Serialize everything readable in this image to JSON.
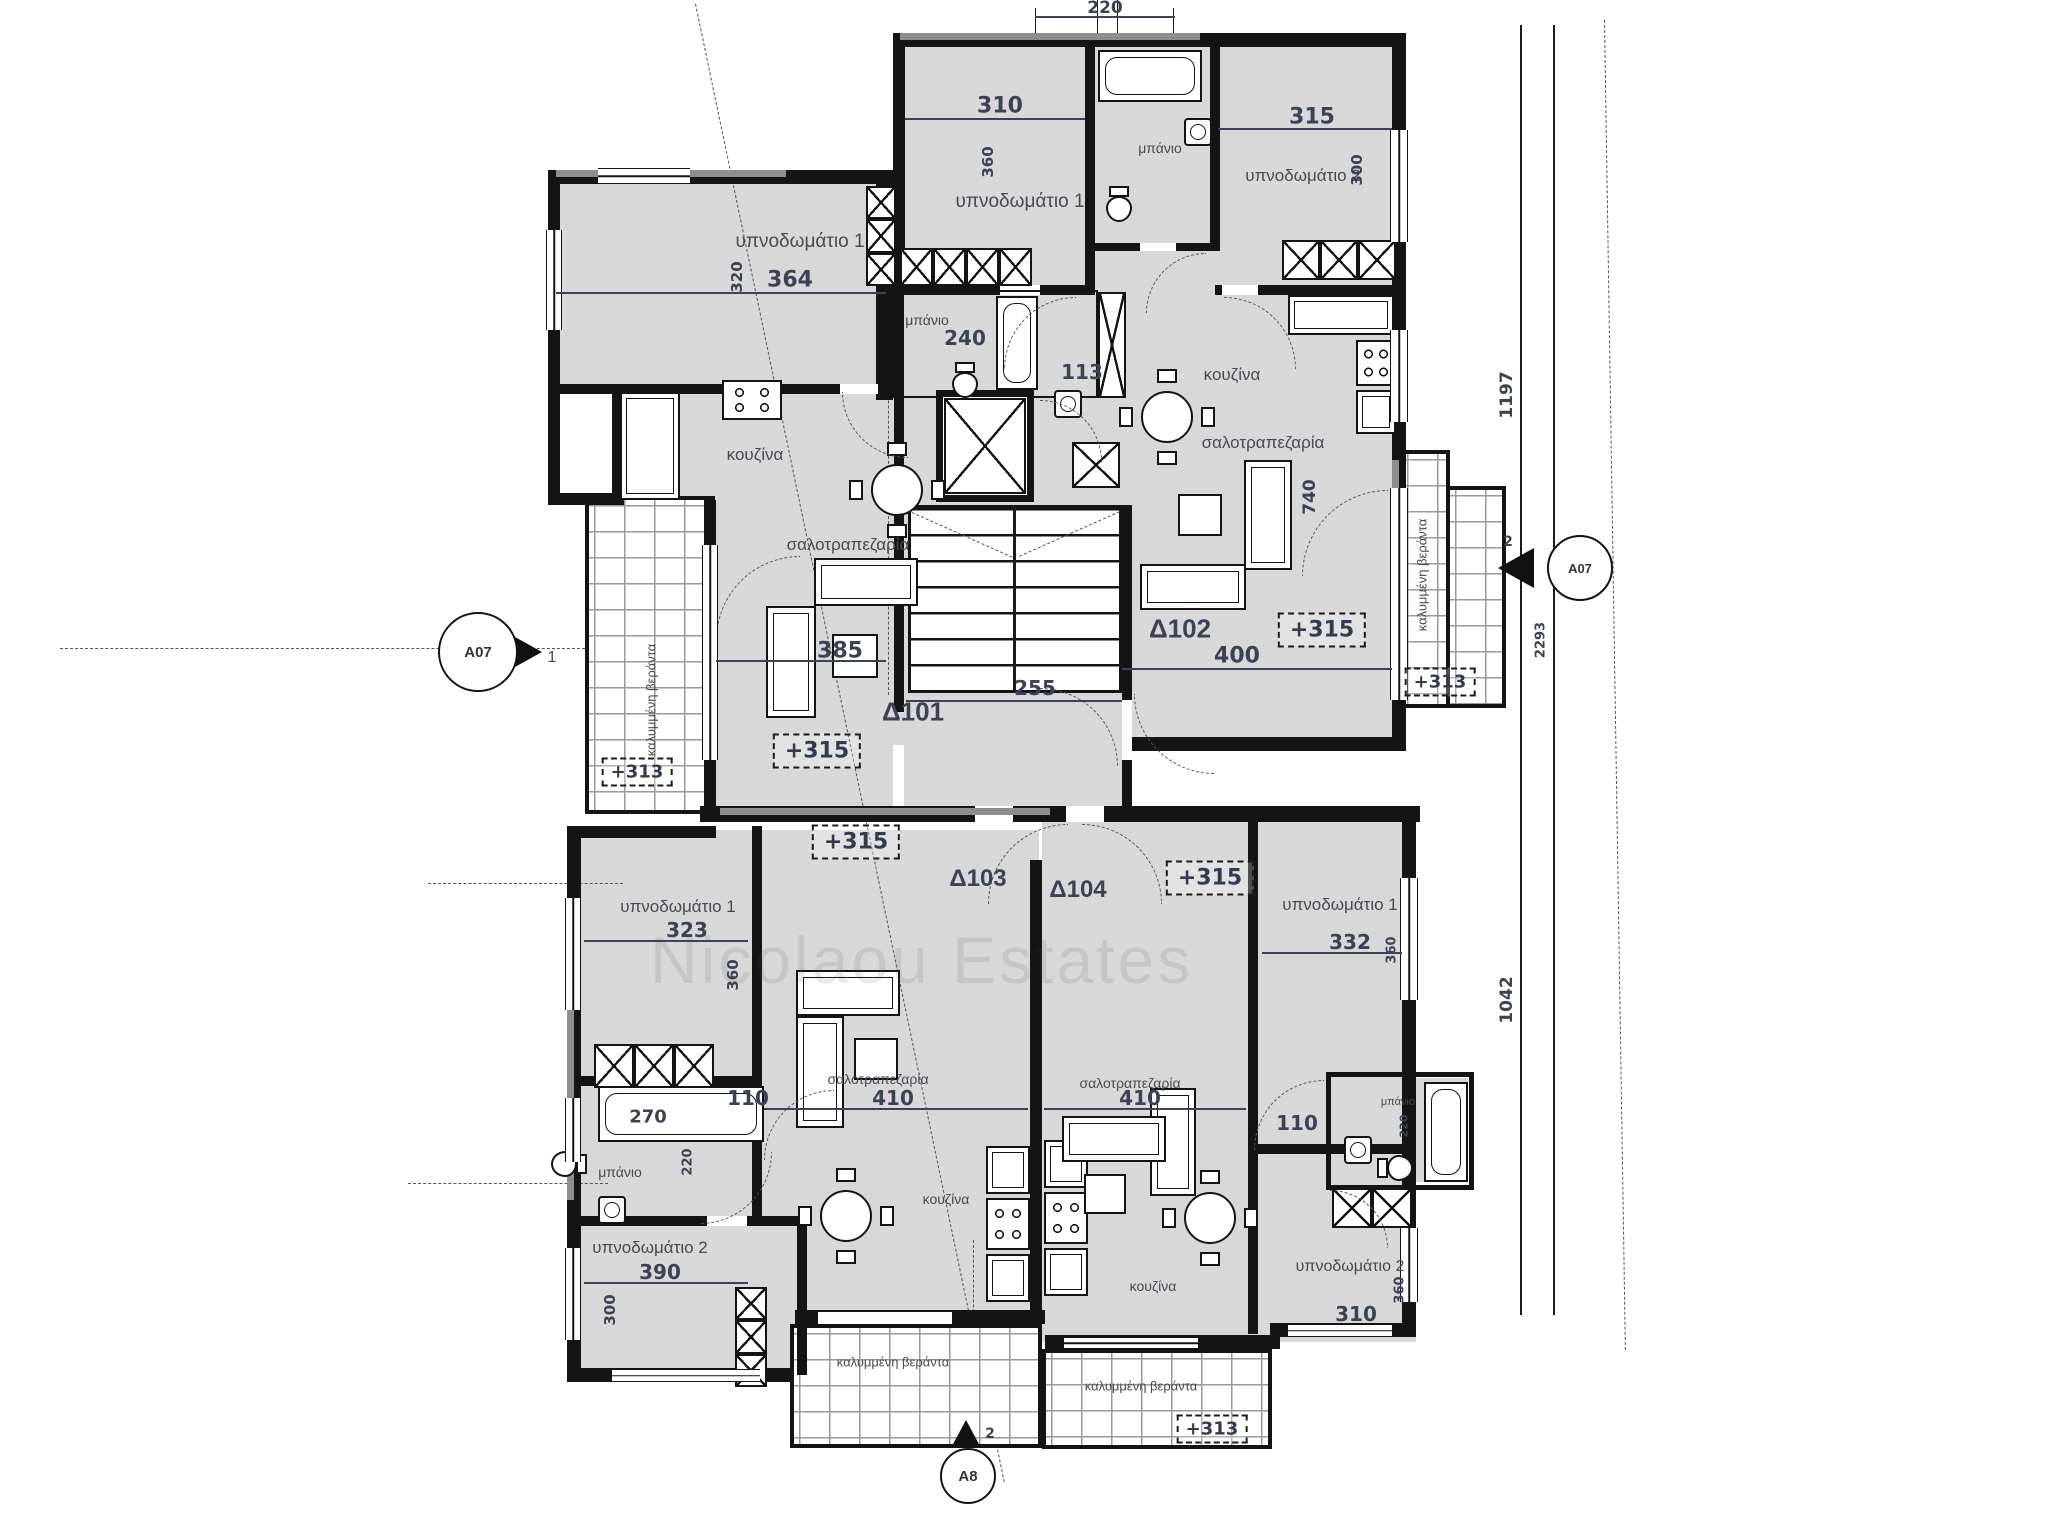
{
  "watermark": "Nicolaou Estates",
  "top_dimension": "220",
  "site_dimensions": {
    "right_upper": "1197",
    "right_total": "2293",
    "right_lower": "1042",
    "right_tick": "2",
    "bottom_tick": "2"
  },
  "section_markers": {
    "left": {
      "label": "A07",
      "number": "1"
    },
    "right": {
      "label": "A07"
    },
    "bottom": {
      "label": "A8"
    }
  },
  "hall": {
    "stair_width": "255"
  },
  "verandas": {
    "left": {
      "name": "καλυμμένη βεράντα",
      "level": "+313"
    },
    "right": {
      "name": "καλυμμένη βεράντα",
      "level": "+313"
    },
    "bottom_left": {
      "name": "καλυμμένη βεράντα"
    },
    "bottom_right": {
      "name": "καλυμμένη βεράντα",
      "level": "+313"
    }
  },
  "apartments": {
    "d101": {
      "id": "Δ101",
      "level": "+315",
      "bedroom1": {
        "name": "υπνοδωμάτιο 1",
        "width": "364",
        "depth": "320"
      },
      "bath": {
        "name": "μπάνιο",
        "width": "240",
        "door": "113"
      },
      "kitchen": {
        "name": "κουζίνα"
      },
      "living": {
        "name": "σαλοτραπεζαρία",
        "width": "385"
      }
    },
    "d102": {
      "id": "Δ102",
      "level": "+315",
      "bedroom1": {
        "name": "υπνοδωμάτιο 1",
        "width": "310",
        "depth": "360"
      },
      "bath": {
        "name": "μπάνιο"
      },
      "bedroom2": {
        "name": "υπνοδωμάτιο 2",
        "width": "315",
        "depth": "300"
      },
      "kitchen": {
        "name": "κουζίνα"
      },
      "living": {
        "name": "σαλοτραπεζαρία",
        "width": "400",
        "depth": "740"
      }
    },
    "d103": {
      "id": "Δ103",
      "level": "+315",
      "bedroom1": {
        "name": "υπνοδωμάτιο 1",
        "width": "323",
        "depth": "360"
      },
      "bath": {
        "name": "μπάνιο",
        "tub": "270",
        "depth": "220"
      },
      "corridor": "110",
      "bedroom2": {
        "name": "υπνοδωμάτιο 2",
        "width": "390",
        "depth": "300"
      },
      "kitchen": {
        "name": "κουζίνα"
      },
      "living": {
        "name": "σαλοτραπεζαρία",
        "width": "410"
      }
    },
    "d104": {
      "id": "Δ104",
      "level": "+315",
      "bedroom1": {
        "name": "υπνοδωμάτιο 1",
        "width": "332",
        "depth": "360"
      },
      "bath": {
        "name": "μπάνιο",
        "depth": "220"
      },
      "corridor": "110",
      "bedroom2": {
        "name": "υπνοδωμάτιο 2",
        "width": "310",
        "depth": "360"
      },
      "kitchen": {
        "name": "κουζίνα"
      },
      "living": {
        "name": "σαλοτραπεζαρία",
        "width": "410"
      }
    }
  }
}
